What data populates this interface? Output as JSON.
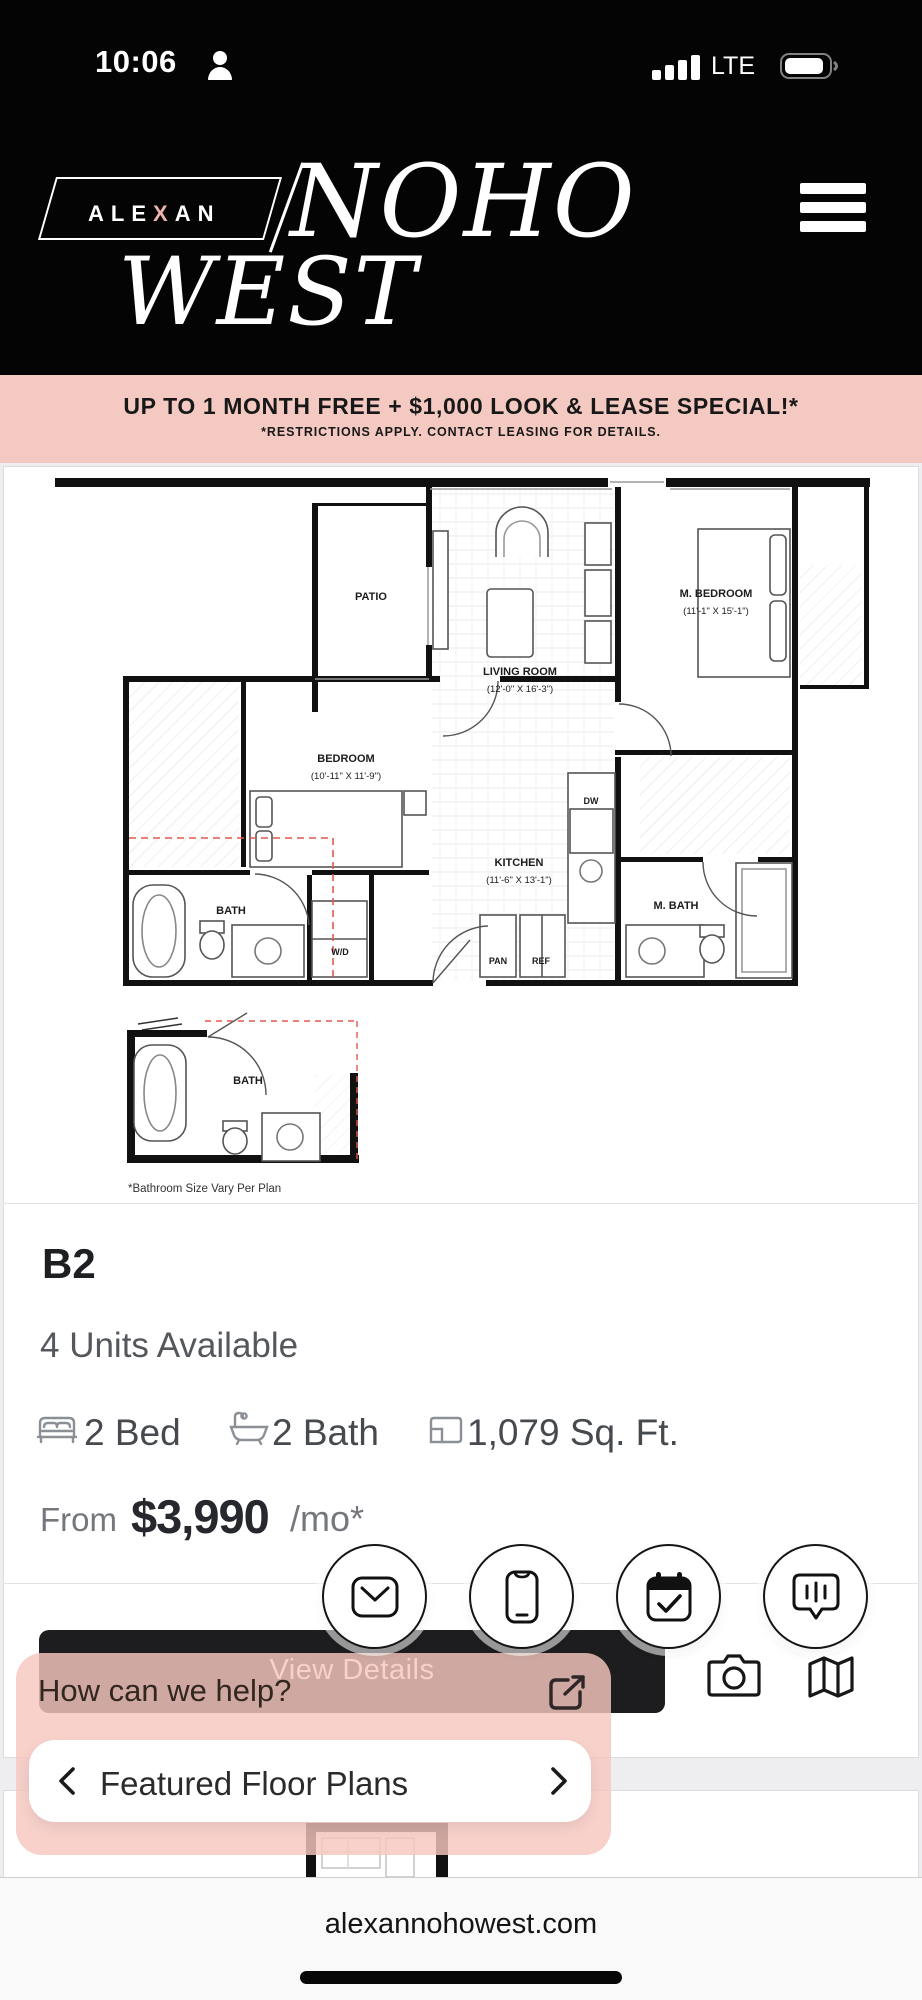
{
  "status_bar": {
    "time": "10:06",
    "network": "LTE"
  },
  "header": {
    "brand_pre": "ALE",
    "brand_x": "X",
    "brand_post": "AN",
    "brand_noho": "NOHO",
    "brand_west": "WEST"
  },
  "banner": {
    "line1": "UP TO 1 MONTH FREE + $1,000 LOOK & LEASE SPECIAL!*",
    "line2": "*RESTRICTIONS APPLY. CONTACT LEASING FOR DETAILS."
  },
  "floorplan": {
    "rooms": [
      {
        "name": "PATIO",
        "dims": ""
      },
      {
        "name": "LIVING ROOM",
        "dims": "(12'-0\" X 16'-3\")"
      },
      {
        "name": "M. BEDROOM",
        "dims": "(11'-1\" X 15'-1\")"
      },
      {
        "name": "BEDROOM",
        "dims": "(10'-11\" X 11'-9\")"
      },
      {
        "name": "KITCHEN",
        "dims": "(11'-6\" X 13'-1\")"
      },
      {
        "name": "BATH",
        "dims": ""
      },
      {
        "name": "M. BATH",
        "dims": ""
      },
      {
        "name": "W/D",
        "dims": ""
      },
      {
        "name": "DW",
        "dims": ""
      },
      {
        "name": "PAN",
        "dims": ""
      },
      {
        "name": "REF",
        "dims": ""
      },
      {
        "name": "BATH",
        "dims": ""
      }
    ],
    "caption": "*Bathroom Size Vary Per Plan"
  },
  "unit": {
    "name": "B2",
    "availability": "4 Units Available",
    "beds": "2 Bed",
    "baths": "2 Bath",
    "sqft": "1,079 Sq. Ft.",
    "price_prefix": "From",
    "price": "$3,990",
    "price_suffix": "/mo*"
  },
  "card": {
    "view_details": "View Details"
  },
  "chat": {
    "prompt": "How can we help?"
  },
  "carousel": {
    "label": "Featured Floor Plans"
  },
  "browser": {
    "url": "alexannohowest.com"
  },
  "colors": {
    "header_bg": "#040404",
    "banner_bg": "#f4c9c2",
    "chat_overlay": "#f6c7bf",
    "brand_x": "#eab3ab",
    "button_bg": "#1d1d1f",
    "red_dash": "#e0584f"
  }
}
